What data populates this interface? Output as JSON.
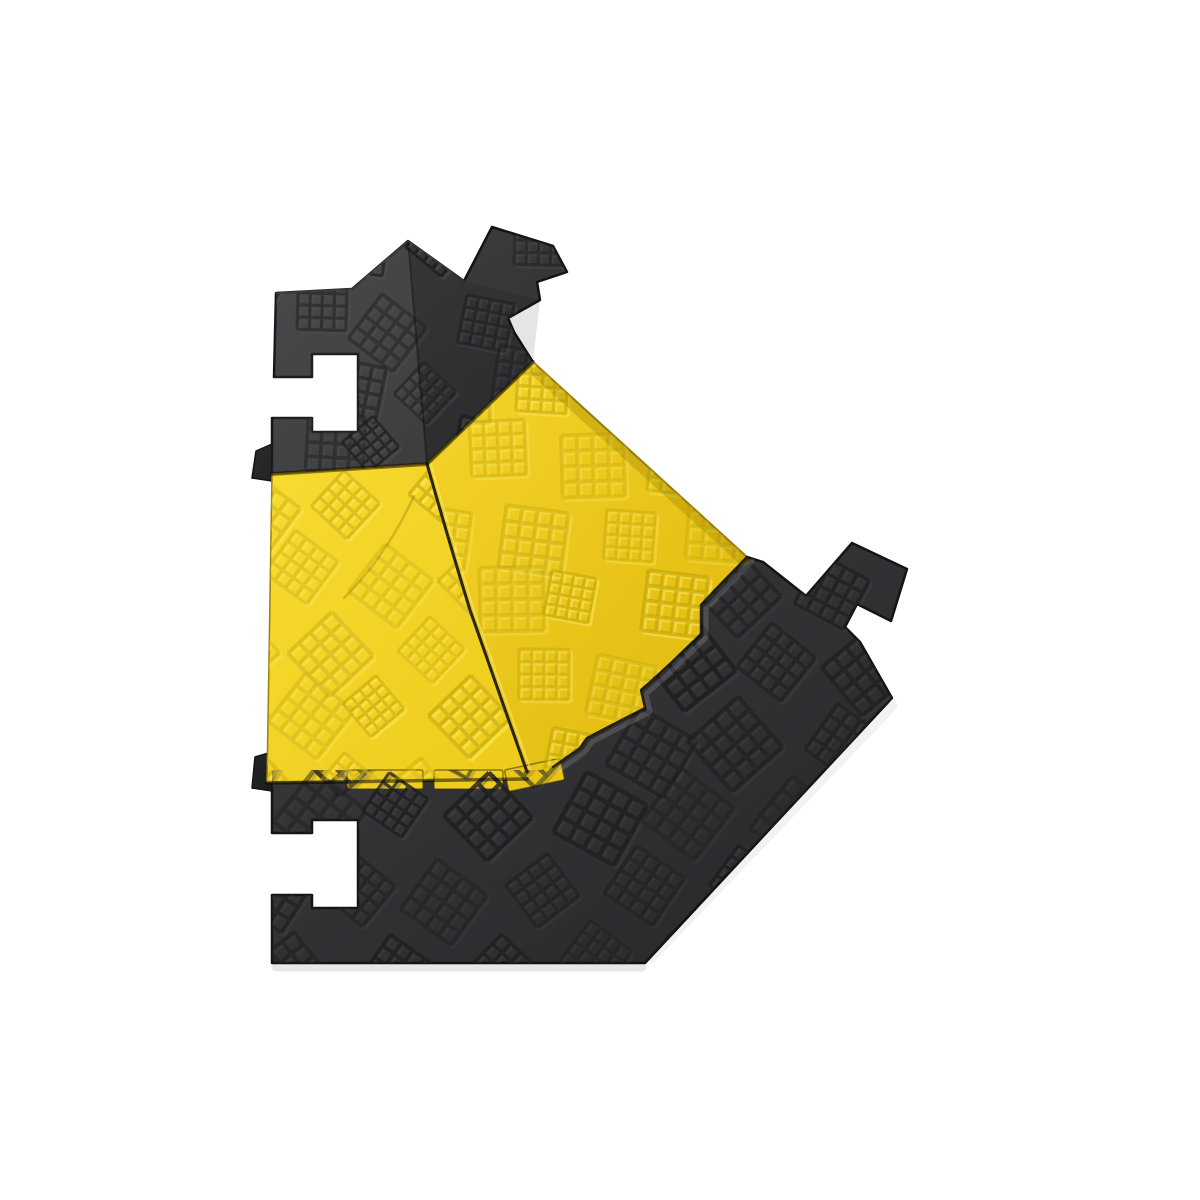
{
  "scene": {
    "subject": "cable-protector-ramp-corner-piece",
    "background_color": "#ffffff"
  },
  "palette": {
    "black_ramp_light": "#424245",
    "black_ramp_dark": "#27272a",
    "lid_yellow_bright": "#f8db31",
    "lid_yellow_deep": "#deb70c",
    "seam_dark": "#2a250e",
    "edge_dark": "#141416"
  },
  "artwork": {
    "canvas": {
      "w": 1200,
      "h": 1200
    },
    "glyph": {
      "unit": 54,
      "lines": 5,
      "stroke_width": 3.6
    },
    "pieces": [
      {
        "id": "B",
        "name": "lower-black-ramp",
        "path": "M272,770 L540,770 L553,767 L580,748 L587,738 L610,726 L645,708 L641,690 L648,684 L672,662 L701,634 L701,605 L714,591 L747,557 L763,562 L806,596 L852,543 L907,569 L891,621 L857,604 L845,627 L860,642 L892,698 L645,963 L272,963 L272,895 L312,895 L312,908 L358,908 L358,820 L312,820 L312,833 L272,833 Z",
        "fill": [
          "#3b3b3e",
          "#27272a"
        ],
        "stroke": "#141416",
        "stroke_width": 2.5
      },
      {
        "id": "lipB",
        "name": "lower-ramp-hinge-lip",
        "path": "M272,752 L255,757 L252,788 L272,791 Z",
        "fill": [
          "#242427",
          "#1d1d20"
        ],
        "stroke": "#141416",
        "stroke_width": 1.5
      },
      {
        "id": "A",
        "name": "upper-black-ramp",
        "path": "M276,293 L352,289 L408,241 L464,281 L492,227 L553,246 L567,272 L537,282 L540,300 L508,318 L514,332 L533,362 L427,464 L272,474 L272,418 L312,418 L312,432 L358,432 L358,354 L312,354 L312,377 L274,377 Z",
        "fill": [
          "#424245",
          "#2e2e31"
        ],
        "stroke": "#141416",
        "stroke_width": 2.5
      },
      {
        "id": "lipA",
        "name": "upper-ramp-hinge-lip",
        "path": "M272,444 L256,451 L252,478 L272,481 Z",
        "fill": [
          "#2c2c2f",
          "#232326"
        ],
        "stroke": "#141416",
        "stroke_width": 1.5
      },
      {
        "id": "Y1",
        "name": "left-yellow-lid",
        "path": "M272,474 L427,464 Q450,545 470,610 Q500,695 527,772 L527,779 L267,782 Z",
        "fill": [
          "#f8db31",
          "#eccb1a"
        ],
        "stroke": "#9a7f05",
        "stroke_width": 1.5
      },
      {
        "id": "Y2",
        "name": "right-yellow-lid",
        "path": "M533,362 L747,557 L714,591 L701,605 L701,634 L672,662 L648,684 L641,690 L645,708 L610,726 L587,738 L580,748 L553,767 L527,772 Q500,695 470,610 Q450,545 427,464 Z",
        "fill": [
          "#f5d52a",
          "#deb70c"
        ],
        "stroke": "#967c05",
        "stroke_width": 2
      }
    ],
    "overlays": [
      {
        "name": "upper-ramp-left-face-highlight",
        "path": "M276,293 L352,289 L408,241 L427,464 L272,474 Z",
        "fill": "rgba(255,255,255,0.05)"
      },
      {
        "name": "upper-ramp-right-face-shade",
        "path": "M408,241 L464,281 L540,300 L533,362 L427,464 Z",
        "fill": "rgba(0,0,0,0.10)"
      }
    ],
    "tabs": [
      {
        "name": "lid-hinge-tab-1",
        "x": 347,
        "y": 770,
        "w": 76,
        "h": 19,
        "rx": 2,
        "fill": "#eecd1d",
        "stroke": "rgba(60,48,0,0.55)"
      },
      {
        "name": "lid-hinge-tab-2",
        "x": 434,
        "y": 770,
        "w": 69,
        "h": 19,
        "rx": 2,
        "fill": "#eecd1d",
        "stroke": "rgba(60,48,0,0.55)"
      },
      {
        "name": "lid-hinge-tab-3",
        "x": 506,
        "y": 764,
        "w": 57,
        "h": 22,
        "rx": 2,
        "fill": "#e7c415",
        "stroke": "rgba(60,48,0,0.55)",
        "transform": "rotate(-12 534 775)"
      }
    ],
    "textures": [
      {
        "piece": "A",
        "name": "texture-upper-ramp",
        "x0": 258,
        "y0": 220,
        "x1": 580,
        "y1": 490,
        "spacing": 84,
        "rots": [
          45,
          10
        ],
        "size": 50,
        "dark": "#1c1c1e",
        "light": "#55555a",
        "dark_op": 0.8,
        "light_op": 0.45
      },
      {
        "piece": "B",
        "name": "texture-lower-ramp",
        "x0": 258,
        "y0": 550,
        "x1": 910,
        "y1": 975,
        "spacing": 95,
        "rots": [
          30,
          45
        ],
        "size": 58,
        "dark": "#1d1d1f",
        "light": "#46464a",
        "dark_op": 0.85,
        "light_op": 0.4
      },
      {
        "piece": "Y1",
        "name": "texture-left-lid",
        "x0": 252,
        "y0": 465,
        "x1": 515,
        "y1": 795,
        "spacing": 90,
        "rots": [
          45
        ],
        "size": 54,
        "dark": "#bfa004",
        "light": "#ffee66",
        "dark_op": 0.6,
        "light_op": 0.5
      },
      {
        "piece": "Y2",
        "name": "texture-right-lid",
        "x0": 425,
        "y0": 355,
        "x1": 765,
        "y1": 800,
        "spacing": 92,
        "rots": [
          6
        ],
        "size": 56,
        "dark": "#bda004",
        "light": "#ffee66",
        "dark_op": 0.6,
        "light_op": 0.5
      }
    ],
    "lines": [
      {
        "name": "shadow-under-upper-ramp-left",
        "path": "M272,474 L427,464",
        "stroke": "rgba(20,16,0,0.5)",
        "w": 4
      },
      {
        "name": "shadow-under-upper-ramp-right",
        "path": "M427,464 L533,362",
        "stroke": "rgba(20,16,0,0.5)",
        "w": 4
      },
      {
        "name": "right-lid-edge-band",
        "path": "M536,372 L744,561",
        "stroke": "rgba(150,120,0,0.3)",
        "w": 10
      },
      {
        "name": "lower-ramp-bevel-highlight",
        "path": "M747,557 L714,591 L701,605 L701,634 L672,662 L648,684 L641,690 L645,708 L610,726 L587,738 L580,748 L553,767",
        "stroke": "rgba(255,255,255,0.14)",
        "w": 5,
        "transform": "translate(5,4)"
      },
      {
        "name": "right-lid-border-shadow",
        "path": "M747,557 L714,591 L701,605 L701,634 L672,662 L648,684 L641,690 L645,708 L610,726 L587,738 L580,748 L553,767",
        "stroke": "rgba(10,10,12,0.8)",
        "w": 2.5
      },
      {
        "name": "lid-seam",
        "path": "M427,464 Q450,545 470,610 Q500,695 527,772",
        "stroke": "#2a250e",
        "w": 3
      },
      {
        "name": "lid-seam-highlight",
        "path": "M431,464 Q454,545 474,610 Q504,695 531,771",
        "stroke": "rgba(255,238,120,0.55)",
        "w": 1.6
      },
      {
        "name": "upper-ramp-ridge-crease",
        "path": "M408,241 L427,464",
        "stroke": "rgba(0,0,0,0.32)",
        "w": 2
      },
      {
        "name": "left-lid-mold-crease",
        "path": "M414,496 Q384,560 344,598",
        "stroke": "rgba(130,104,0,0.3)",
        "w": 2.5
      },
      {
        "name": "bottom-lid-edge-shadow",
        "path": "M267,783 L527,779",
        "stroke": "rgba(0,0,0,0.5)",
        "w": 3.5
      },
      {
        "name": "upper-ramp-top-edge-highlight",
        "path": "M276,293 L352,289 L408,241 L464,281",
        "stroke": "rgba(255,255,255,0.14)",
        "w": 2
      },
      {
        "name": "ground-shadow-bottom",
        "path": "M276,967 L642,967",
        "stroke": "rgba(0,0,0,0.09)",
        "w": 9
      },
      {
        "name": "ground-shadow-diagonal",
        "path": "M652,958 L893,706",
        "stroke": "rgba(0,0,0,0.05)",
        "w": 9
      }
    ]
  }
}
